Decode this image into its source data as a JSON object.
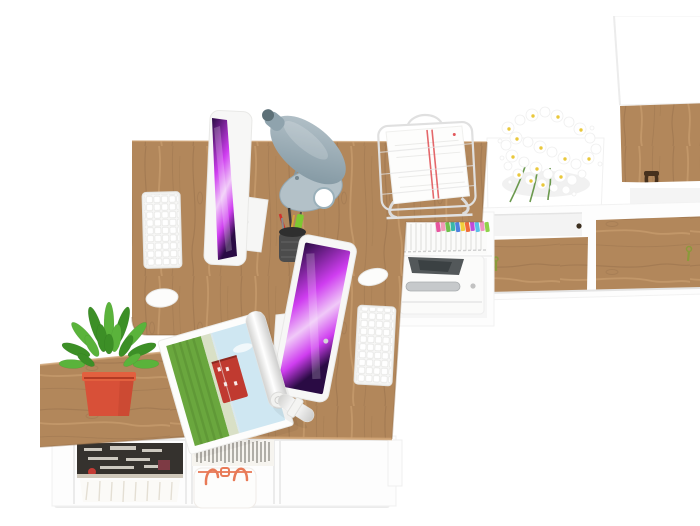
{
  "meta": {
    "title": "Top-down 3D render of a two-person office workspace",
    "view": "bird's-eye",
    "canvas": {
      "width": 700,
      "height": 494
    }
  },
  "palette": {
    "bg": "#ffffff",
    "wood": "#b2875b",
    "wood-grain": "#8f6a45",
    "wood-light": "#cfa374",
    "white-surface": "#fdfdfd",
    "panel-line": "#ececec",
    "screen-dark": "#2a0b44",
    "screen-magenta": "#cf3df0",
    "screen-light": "#f0c9f8",
    "device-white": "#f7f7f6",
    "key-line": "#e6e6e4",
    "lamp-steel": "#b9c6cd",
    "lamp-steel-dark": "#7d939e",
    "plant-green": "#5ab33b",
    "plant-green-dark": "#3c8f26",
    "pot-red": "#d85038",
    "pot-red-dark": "#b23a24",
    "bag-orange": "#e87a57",
    "paper-stripe-red": "#e2585c",
    "pen-red": "#d0312d",
    "highlighter-green": "#7ec832",
    "magazine-grass": "#6aa73e",
    "magazine-sky": "#cfe7f2",
    "magazine-house-red": "#c03a30",
    "books-dark": "#35322e",
    "knob-dark": "#3c2f1f",
    "key-green": "#8a9a3a",
    "metal-gray": "#c6c9cb",
    "printer-dark": "#53585a",
    "daisy-center": "#e9c83c",
    "tabs": [
      "#e8559f",
      "#f29ab8",
      "#6fc04a",
      "#38b8a8",
      "#4f7fe0",
      "#f2cf3a",
      "#ef6a3a",
      "#c04adb",
      "#58c0e8",
      "#f093c0",
      "#8fd24a"
    ]
  },
  "objects": {
    "main_desk": {
      "label": "Oak two-person desk top"
    },
    "return_table": {
      "label": "Oak side return table"
    },
    "bottom_shelf": {
      "label": "Low white shelf with magazines, booklets and shopper bag"
    },
    "magazines": {
      "label": "Stack of magazines"
    },
    "books": {
      "label": "Row of booklets on edge"
    },
    "bag": {
      "label": "White shopper bag with coral handles"
    },
    "plant": {
      "label": "Green succulent in coral square pot"
    },
    "imac_1": {
      "label": "All-in-one computer, purple wallpaper"
    },
    "imac_2": {
      "label": "All-in-one computer, purple wallpaper"
    },
    "keyboard_1": {
      "label": "White wireless keyboard"
    },
    "keyboard_2": {
      "label": "White wireless keyboard"
    },
    "mouse_1": {
      "label": "White mouse"
    },
    "mouse_2": {
      "label": "White mouse"
    },
    "lamp": {
      "label": "Steel-blue cone desk lamp"
    },
    "pen_cup": {
      "label": "Black mesh pen cup with pens"
    },
    "document_tray": {
      "label": "White wire tray with red-striped documents"
    },
    "flowers": {
      "label": "Bouquet of white daisies"
    },
    "flower_table": {
      "label": "White side table"
    },
    "magazine_open": {
      "label": "Open magazine with countryside photo"
    },
    "rolled_document": {
      "label": "Rolled document with paper band"
    },
    "binder_shelf": {
      "label": "Shelf with white file folders and colored index tabs"
    },
    "printer": {
      "label": "Compact white printer"
    },
    "sideboard": {
      "label": "White sideboard with oak doors"
    },
    "tall_cabinet": {
      "label": "Tall white cabinet with oak door"
    }
  }
}
